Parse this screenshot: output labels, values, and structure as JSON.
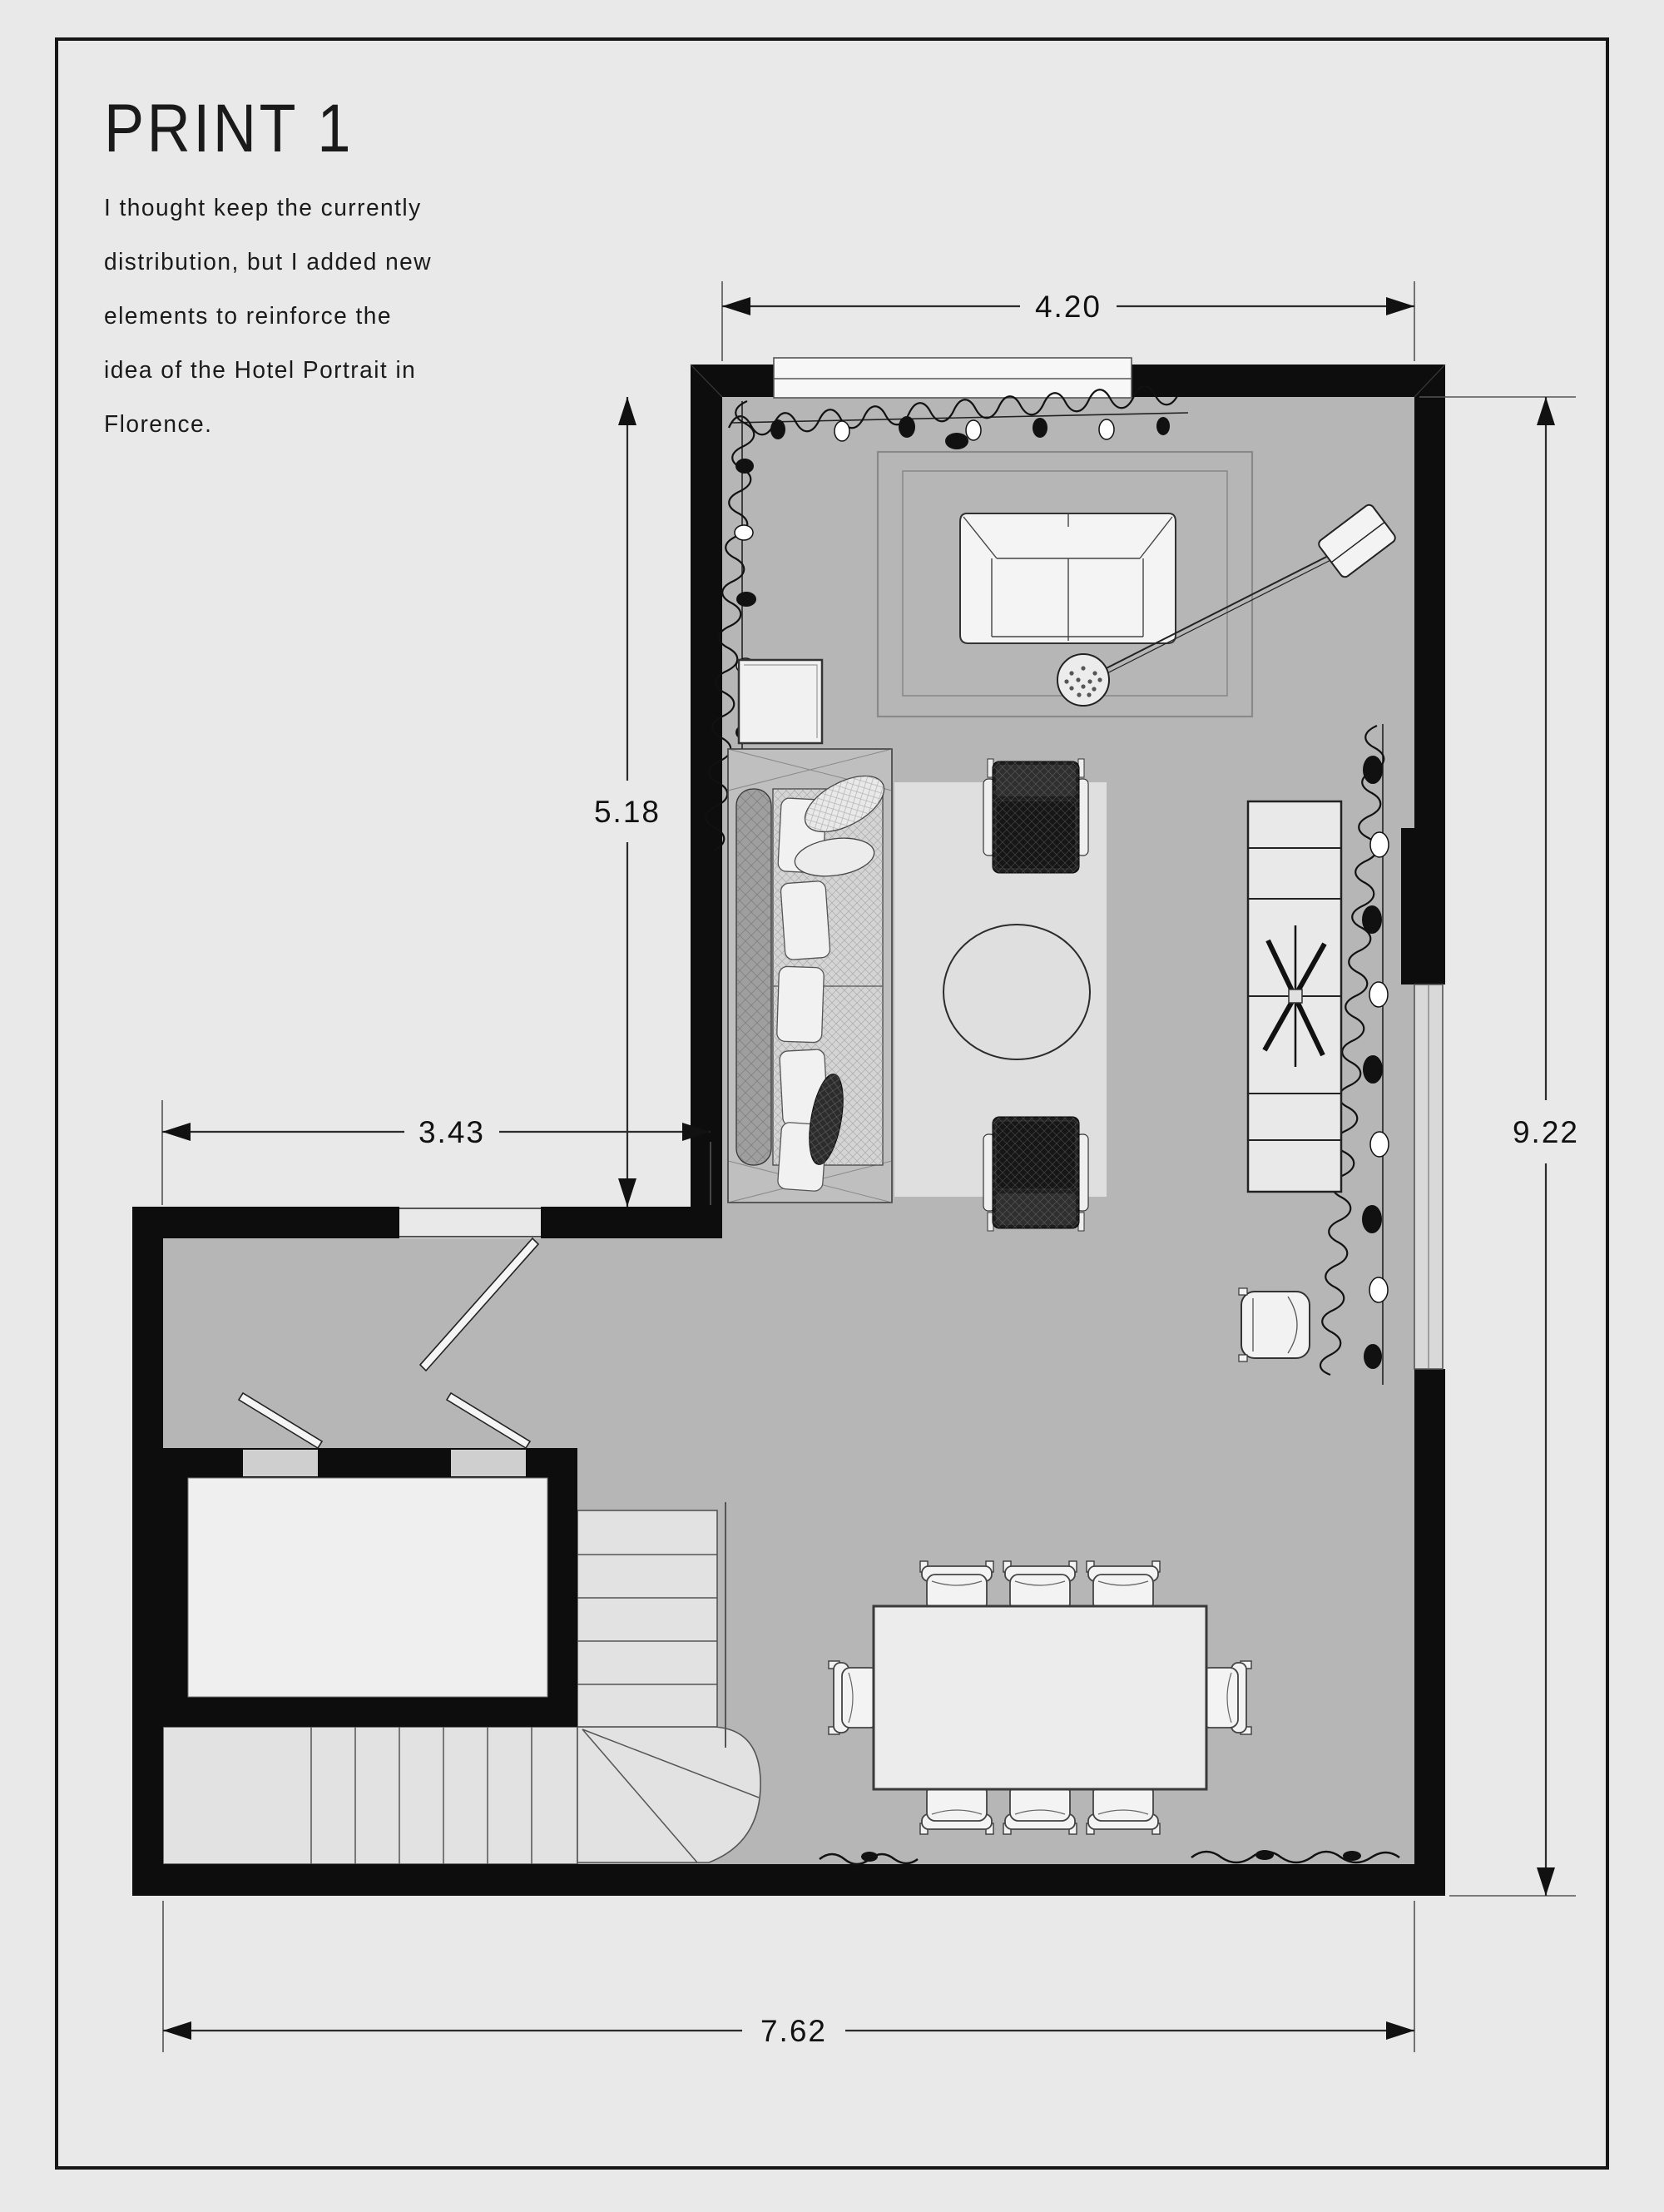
{
  "sheet": {
    "title": "PRINT 1",
    "note_lines": [
      "I thought keep the currently",
      "distribution, but I added new",
      "elements to reinforce the",
      "idea of the Hotel Portrait in",
      "Florence."
    ]
  },
  "dimensions": {
    "top": "4.20",
    "upper_left": "5.18",
    "mid_left": "3.43",
    "right": "9.22",
    "bottom": "7.62"
  },
  "colors": {
    "page_bg": "#e9e9e9",
    "floor": "#b6b6b6",
    "wall": "#0d0d0d",
    "rug": "#dfdfdf",
    "stair": "#e2e2e2",
    "furniture_light": "#f3f3f3",
    "ink": "#1a1a1a"
  }
}
